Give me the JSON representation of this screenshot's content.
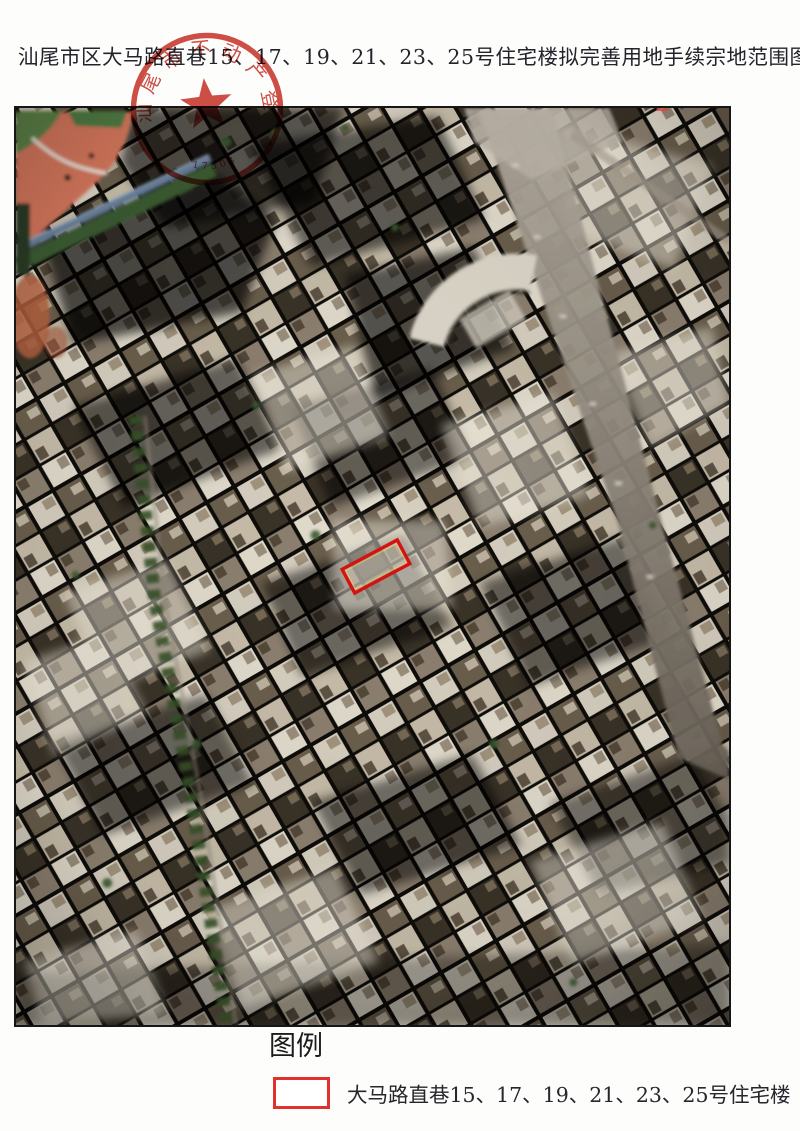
{
  "title": {
    "text": "汕尾市区大马路直巷15、17、19、21、23、25号住宅楼拟完善用地手续宗地范围图"
  },
  "stamp": {
    "ring_text": "汕尾市不动产登记中心",
    "serial_number": "17303",
    "color": "#c93a31",
    "star_icon": "red-star"
  },
  "map": {
    "type": "satellite-photo",
    "border_color": "#161616",
    "parcel_outline_color": "#d31212"
  },
  "legend": {
    "heading": "图例",
    "items": [
      {
        "swatch_color": "#e0312e",
        "label": "大马路直巷15、17、19、21、23、25号住宅楼"
      }
    ]
  }
}
